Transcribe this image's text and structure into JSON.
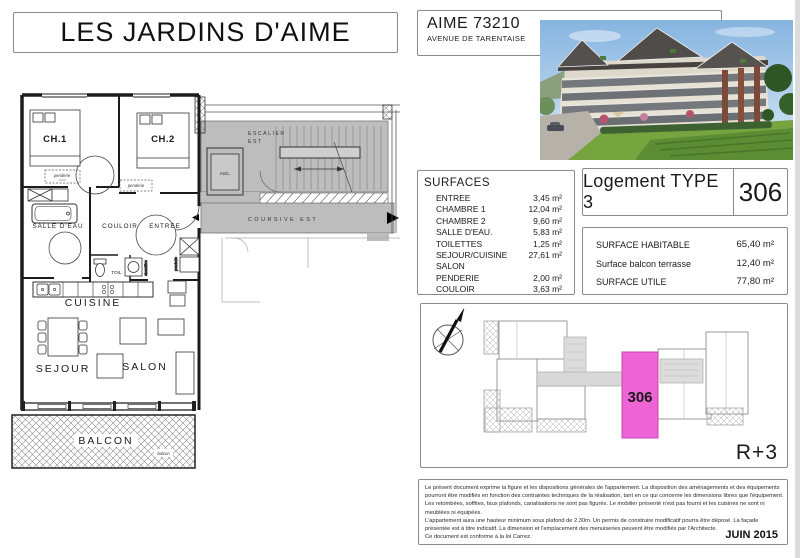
{
  "title": "LES JARDINS D'AIME",
  "address": {
    "line1": "AIME 73210",
    "line2": "AVENUE DE TARENTAISE"
  },
  "surfaces": {
    "heading": "SURFACES",
    "rows": [
      {
        "label": "ENTREE",
        "value": "3,45 m²"
      },
      {
        "label": "CHAMBRE 1",
        "value": "12,04 m²"
      },
      {
        "label": "CHAMBRE 2",
        "value": "9,60 m²"
      },
      {
        "label": "SALLE D'EAU.",
        "value": "5,83 m²"
      },
      {
        "label": "TOILETTES",
        "value": "1,25 m²"
      },
      {
        "label": "SEJOUR/CUISINE",
        "value": "27,61 m²"
      },
      {
        "label": "SALON",
        "value": ""
      },
      {
        "label": "PENDERIE",
        "value": "2,00 m²"
      },
      {
        "label": "COULOIR",
        "value": "3,63 m²"
      }
    ]
  },
  "logement": {
    "type_label": "Logement TYPE 3",
    "unit_number": "306"
  },
  "totals": {
    "rows": [
      {
        "label": "SURFACE HABITABLE",
        "value": "65,40 m²"
      },
      {
        "label": "Surface balcon terrasse",
        "value": "12,40 m²"
      },
      {
        "label": "SURFACE UTILE",
        "value": "77,80 m²"
      }
    ]
  },
  "keyplan": {
    "unit_number": "306",
    "floor_label": "R+3"
  },
  "plan": {
    "labels": {
      "ch1": "CH.1",
      "ch2": "CH.2",
      "salle_deau": "SALLE D'EAU",
      "couloir": "COULOIR",
      "entree": "ENTREE",
      "toil": "TOIL.",
      "cuisine": "CUISINE",
      "sejour": "SEJOUR",
      "salon": "SALON",
      "balcon": "BALCON",
      "balcon_small": "balcon",
      "penderie": "penderie",
      "chaudiere": "chaudière",
      "escalier_l1": "ESCALIER",
      "escalier_l2": "EST",
      "asc": "ASC.",
      "coursive": "COURSIVE EST"
    }
  },
  "legal": {
    "lines": [
      "Le présent document exprime la figure et les dispositions générales de l'appartement. La disposition des aménagements et des équipements",
      "pourront être modifiés en fonction des contraintes techniques de la réalisation, tant en ce qui concerne les dimensions libres que l'équipement.",
      "Les retombées, soffites, faux plafonds, canalisations ne sont pas figurés. Le mobilier présenté n'est pas fourni et les cuisines ne sont ni",
      "meublées ni équipées.",
      "L'appartement aura une hauteur minimum sous plafond de 2.30m. Un permis de construire modificatif pourra être déposé. La façade",
      "présentée est à titre indicatif. La dimension et l'emplacement des menuiseries peuvent être modifiés par l'Architecte.",
      "Ce document est conforme à la loi Carrez."
    ],
    "date": "JUIN 2015"
  },
  "colors": {
    "highlight": "#ee64d6",
    "common_gray": "#bdbdbd"
  }
}
